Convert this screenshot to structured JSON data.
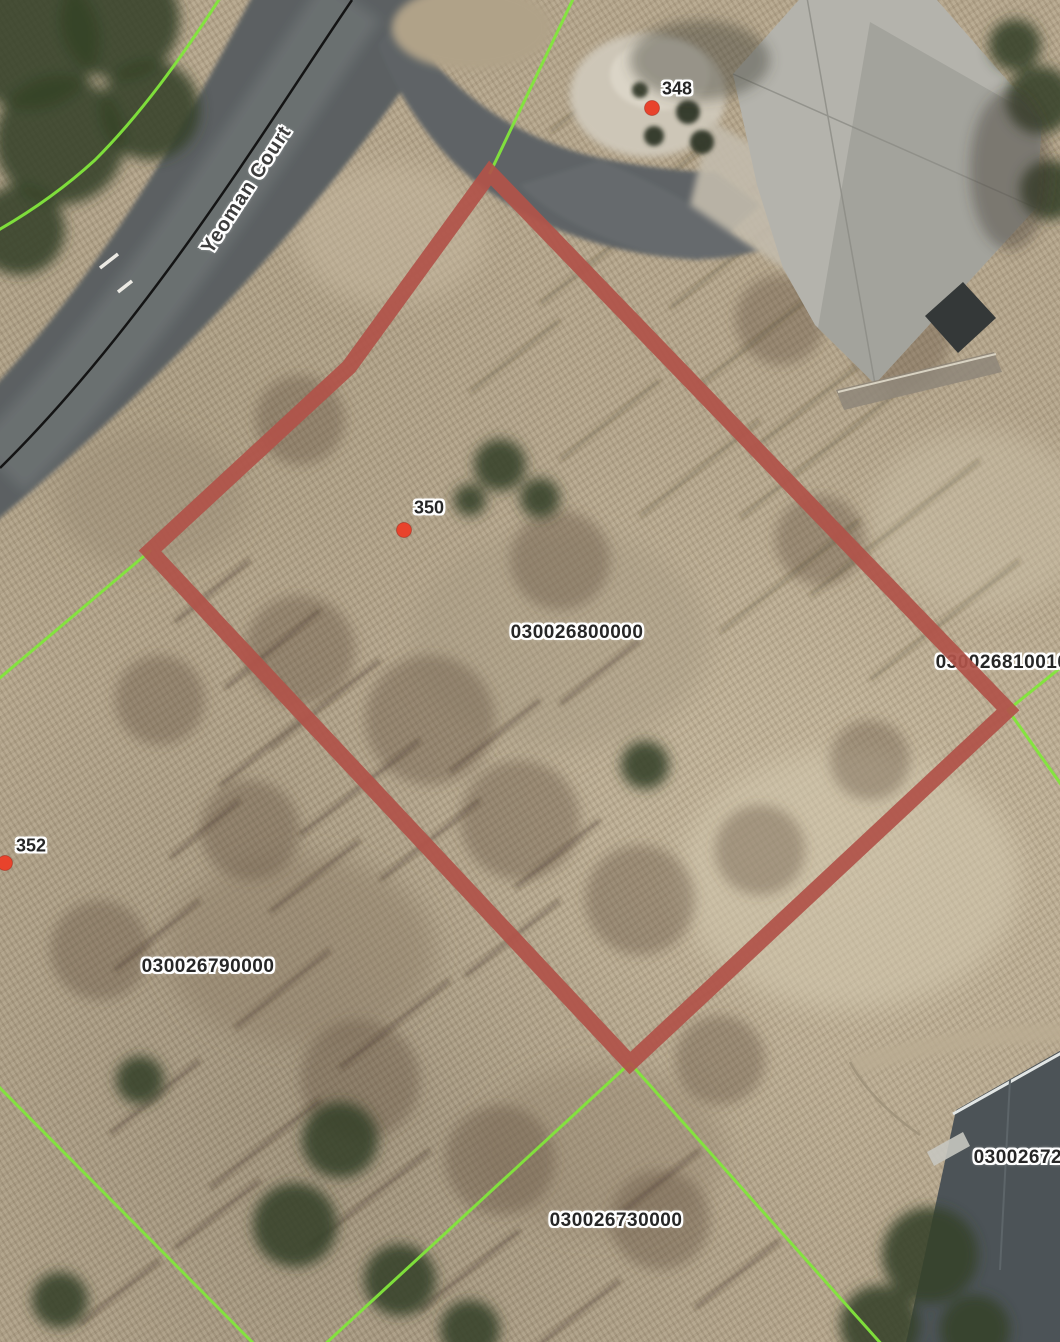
{
  "map": {
    "street": {
      "name": "Yeoman Court"
    },
    "selected_parcel": {
      "id": "030026800000",
      "outline_color": "#b05349"
    },
    "parcel_labels": {
      "selected": "030026800000",
      "west": "030026790000",
      "south": "030026730000",
      "east": "030026810010",
      "southeast": "030026720000"
    },
    "address_markers": {
      "north": {
        "label": "348"
      },
      "selected": {
        "label": "350"
      },
      "west": {
        "label": "352"
      }
    },
    "colors": {
      "parcel_boundary_line": "#82e63c",
      "selected_outline": "#b05349",
      "address_dot": "#e8432c",
      "label_text": "#262626",
      "label_halo": "#ffffff",
      "road": "#5b6062"
    }
  }
}
